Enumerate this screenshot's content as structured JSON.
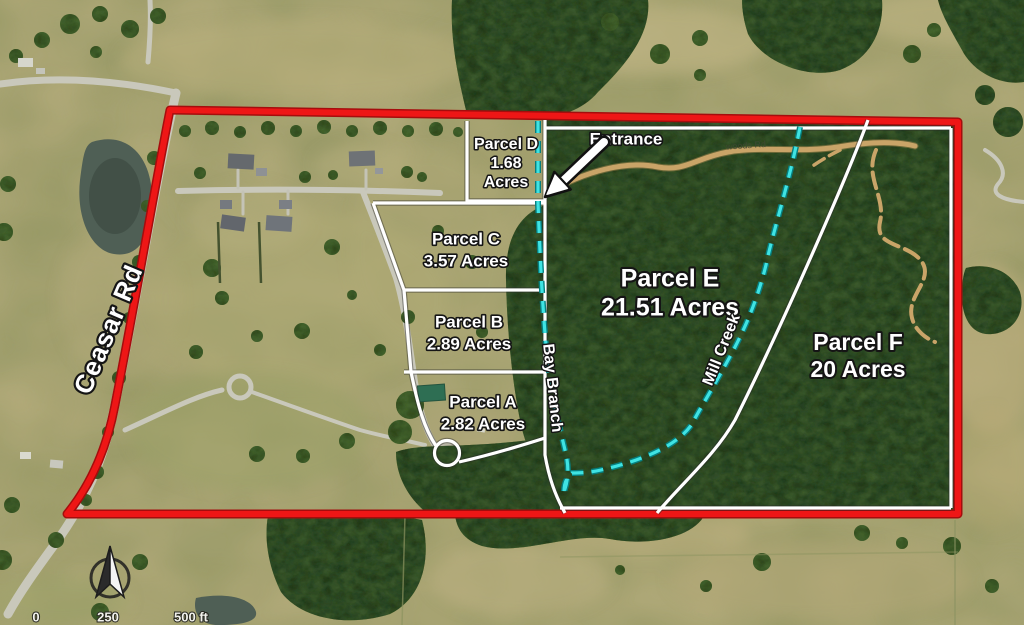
{
  "map": {
    "parcels": [
      {
        "id": "A",
        "lines": [
          "Parcel A",
          "2.82 Acres"
        ]
      },
      {
        "id": "B",
        "lines": [
          "Parcel B",
          "2.89 Acres"
        ]
      },
      {
        "id": "C",
        "lines": [
          "Parcel C",
          "3.57 Acres"
        ]
      },
      {
        "id": "D",
        "lines": [
          "Parcel D",
          "1.68",
          "Acres"
        ]
      },
      {
        "id": "E",
        "lines": [
          "Parcel E",
          "21.51 Acres"
        ]
      },
      {
        "id": "F",
        "lines": [
          "Parcel F",
          "20 Acres"
        ]
      }
    ],
    "annotations": {
      "entrance": "Entrance",
      "ceasar_rd": "Ceasar Rd",
      "bay_branch": "Bay Branch",
      "mill_creek": "Mill Creek",
      "woods_rd": "woods Rd"
    },
    "scale_bar": {
      "start": "0",
      "middle": "250",
      "end": "500 ft"
    },
    "colors": {
      "boundary_red": "#ee1616",
      "parcel_line_white": "#ffffff",
      "creek_cyan": "#3fe3e3",
      "forest_green": "#2c4425",
      "field_olive": "#a6a372",
      "dirt_road_tan": "#c9a468"
    }
  }
}
